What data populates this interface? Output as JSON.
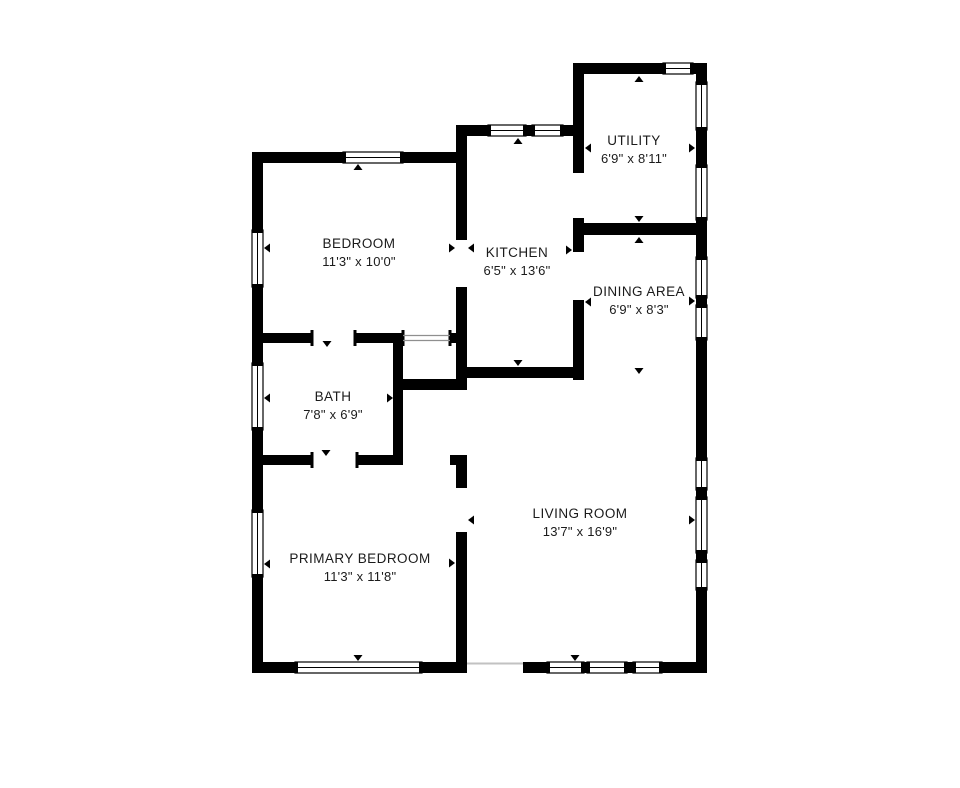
{
  "page": {
    "background": "#ffffff"
  },
  "floorplan": {
    "wall_color": "#000000",
    "window_fill": "#ffffff",
    "window_stroke": "#000000",
    "text_color": "#1b1b1b",
    "rooms": [
      {
        "id": "bedroom",
        "name": "BEDROOM",
        "dims": "11'3\" x 10'0\"",
        "label_x": 359,
        "label_y": 236
      },
      {
        "id": "kitchen",
        "name": "KITCHEN",
        "dims": "6'5\" x 13'6\"",
        "label_x": 517,
        "label_y": 245
      },
      {
        "id": "utility",
        "name": "UTILITY",
        "dims": "6'9\" x 8'11\"",
        "label_x": 634,
        "label_y": 133
      },
      {
        "id": "dining-area",
        "name": "DINING AREA",
        "dims": "6'9\" x 8'3\"",
        "label_x": 639,
        "label_y": 284
      },
      {
        "id": "bath",
        "name": "BATH",
        "dims": "7'8\" x 6'9\"",
        "label_x": 333,
        "label_y": 389
      },
      {
        "id": "primary-bedroom",
        "name": "PRIMARY BEDROOM",
        "dims": "11'3\" x 11'8\"",
        "label_x": 360,
        "label_y": 551
      },
      {
        "id": "living-room",
        "name": "LIVING ROOM",
        "dims": "13'7\" x 16'9\"",
        "label_x": 580,
        "label_y": 506
      }
    ],
    "walls": [
      [
        252,
        152,
        215,
        11
      ],
      [
        252,
        152,
        11,
        521
      ],
      [
        456,
        125,
        128,
        11
      ],
      [
        456,
        125,
        11,
        115
      ],
      [
        456,
        287,
        11,
        103
      ],
      [
        573,
        63,
        134,
        11
      ],
      [
        573,
        63,
        11,
        110
      ],
      [
        696,
        63,
        11,
        610
      ],
      [
        573,
        223,
        134,
        12
      ],
      [
        573,
        218,
        11,
        34
      ],
      [
        573,
        300,
        11,
        80
      ],
      [
        456,
        367,
        128,
        11
      ],
      [
        393,
        379,
        74,
        11
      ],
      [
        393,
        333,
        10,
        132
      ],
      [
        252,
        333,
        60,
        10
      ],
      [
        355,
        333,
        48,
        10
      ],
      [
        450,
        333,
        17,
        10
      ],
      [
        252,
        455,
        60,
        10
      ],
      [
        357,
        455,
        46,
        10
      ],
      [
        450,
        455,
        17,
        10
      ],
      [
        456,
        455,
        11,
        33
      ],
      [
        456,
        532,
        11,
        141
      ],
      [
        252,
        662,
        215,
        11
      ],
      [
        523,
        662,
        184,
        11
      ]
    ],
    "windows": [
      [
        343,
        152,
        60,
        11
      ],
      [
        488,
        125,
        38,
        11
      ],
      [
        532,
        125,
        31,
        11
      ],
      [
        663,
        63,
        30,
        11
      ],
      [
        295,
        662,
        127,
        11
      ],
      [
        547,
        662,
        37,
        11
      ],
      [
        587,
        662,
        40,
        11
      ],
      [
        633,
        662,
        29,
        11
      ],
      [
        252,
        230,
        11,
        57
      ],
      [
        252,
        363,
        11,
        67
      ],
      [
        252,
        510,
        11,
        67
      ],
      [
        696,
        82,
        11,
        48
      ],
      [
        696,
        165,
        11,
        55
      ],
      [
        696,
        257,
        11,
        41
      ],
      [
        696,
        305,
        11,
        35
      ],
      [
        696,
        458,
        11,
        32
      ],
      [
        696,
        497,
        11,
        56
      ],
      [
        696,
        560,
        11,
        30
      ]
    ],
    "jambs": [
      [
        310.5,
        330,
        3,
        16
      ],
      [
        353.5,
        330,
        3,
        16
      ],
      [
        310.5,
        452,
        3,
        16
      ],
      [
        355.5,
        452,
        3,
        16
      ],
      [
        401.5,
        330,
        3,
        16
      ],
      [
        448.5,
        330,
        3,
        16
      ]
    ],
    "thin_lines": [
      {
        "x1": 403,
        "y1": 335.5,
        "x2": 450,
        "y2": 335.5,
        "w": 1.2,
        "color": "#8f8f8f"
      },
      {
        "x1": 403,
        "y1": 340.5,
        "x2": 450,
        "y2": 340.5,
        "w": 1.2,
        "color": "#8f8f8f"
      },
      {
        "x1": 467,
        "y1": 663.5,
        "x2": 523,
        "y2": 663.5,
        "w": 2,
        "color": "#c2c2c2"
      }
    ],
    "markers": [
      {
        "x": 358,
        "y": 164,
        "dir": "up"
      },
      {
        "x": 518,
        "y": 138,
        "dir": "up"
      },
      {
        "x": 639,
        "y": 76,
        "dir": "up"
      },
      {
        "x": 639,
        "y": 237,
        "dir": "up"
      },
      {
        "x": 639,
        "y": 222,
        "dir": "down"
      },
      {
        "x": 639,
        "y": 374,
        "dir": "down"
      },
      {
        "x": 327,
        "y": 347,
        "dir": "down"
      },
      {
        "x": 326,
        "y": 456,
        "dir": "down"
      },
      {
        "x": 518,
        "y": 366,
        "dir": "down"
      },
      {
        "x": 358,
        "y": 661,
        "dir": "down"
      },
      {
        "x": 575,
        "y": 661,
        "dir": "down"
      },
      {
        "x": 264,
        "y": 248,
        "dir": "left"
      },
      {
        "x": 264,
        "y": 398,
        "dir": "left"
      },
      {
        "x": 264,
        "y": 564,
        "dir": "left"
      },
      {
        "x": 585,
        "y": 148,
        "dir": "left"
      },
      {
        "x": 468,
        "y": 248,
        "dir": "left"
      },
      {
        "x": 468,
        "y": 520,
        "dir": "left"
      },
      {
        "x": 585,
        "y": 302,
        "dir": "left"
      },
      {
        "x": 695,
        "y": 148,
        "dir": "right"
      },
      {
        "x": 695,
        "y": 301,
        "dir": "right"
      },
      {
        "x": 695,
        "y": 520,
        "dir": "right"
      },
      {
        "x": 572,
        "y": 250,
        "dir": "right"
      },
      {
        "x": 455,
        "y": 248,
        "dir": "right"
      },
      {
        "x": 455,
        "y": 563,
        "dir": "right"
      },
      {
        "x": 393,
        "y": 398,
        "dir": "right"
      }
    ]
  }
}
